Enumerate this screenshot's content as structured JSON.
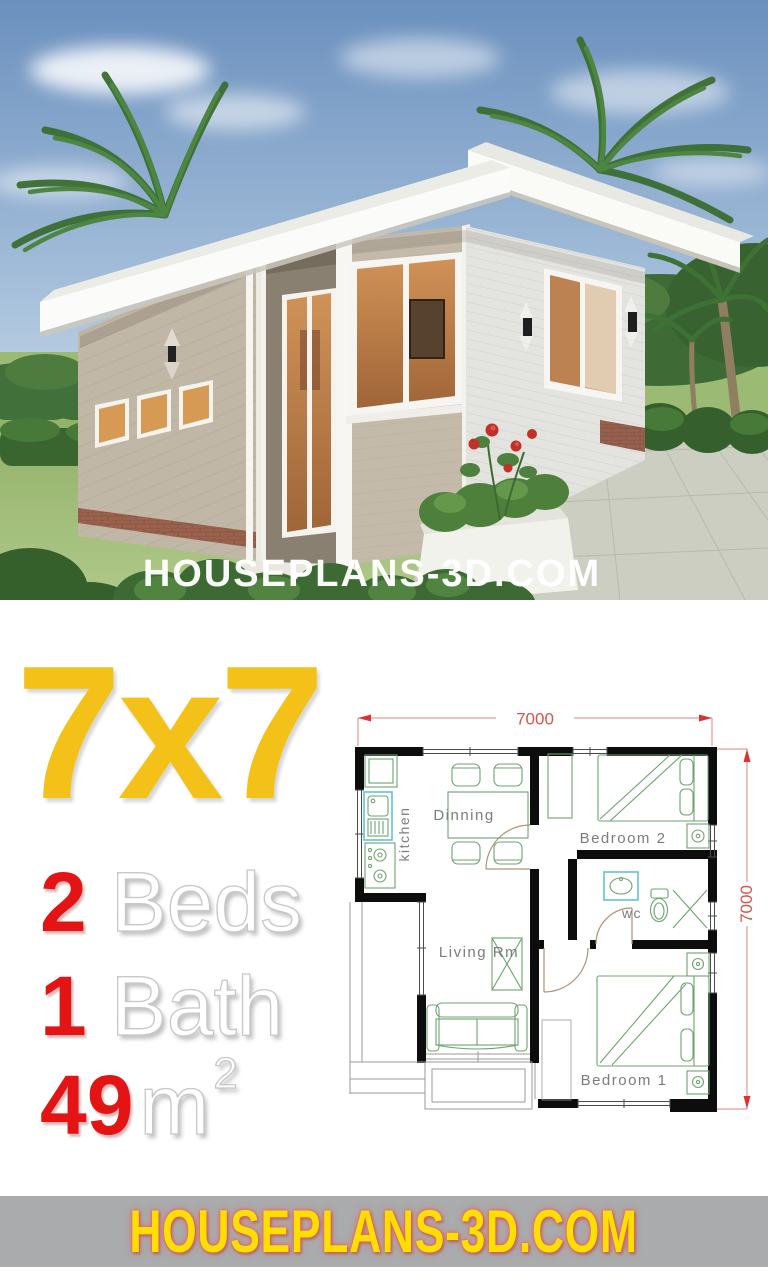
{
  "hero": {
    "watermark": "HOUSEPLANS-3D.COM"
  },
  "plan_size": "7x7",
  "stats": {
    "beds_num": "2",
    "beds_label": "Beds",
    "bath_num": "1",
    "bath_label": "Bath",
    "area_num": "49",
    "area_unit": "m",
    "area_sup": "2"
  },
  "floorplan": {
    "dim_top": "7000",
    "dim_right": "7000",
    "labels": {
      "kitchen": "kitchen",
      "dinning": "Dinning",
      "bedroom2": "Bedroom 2",
      "wc": "wc",
      "living": "Living Rm",
      "bedroom1": "Bedroom 1"
    }
  },
  "footer": {
    "site": "HOUSEPLANS-3D.COM"
  },
  "colors": {
    "accent_yellow": "#F3C117",
    "accent_red": "#E41414",
    "footer_bg": "#A9ABAC",
    "footer_text": "#FFDE00",
    "plan_wall": "#0d0d0d",
    "plan_furniture_green": "#6FA26F",
    "plan_fixture_cyan": "#5FC4D0",
    "plan_dim_red": "#D9534B",
    "plan_label_gray": "#7c7c7c"
  }
}
